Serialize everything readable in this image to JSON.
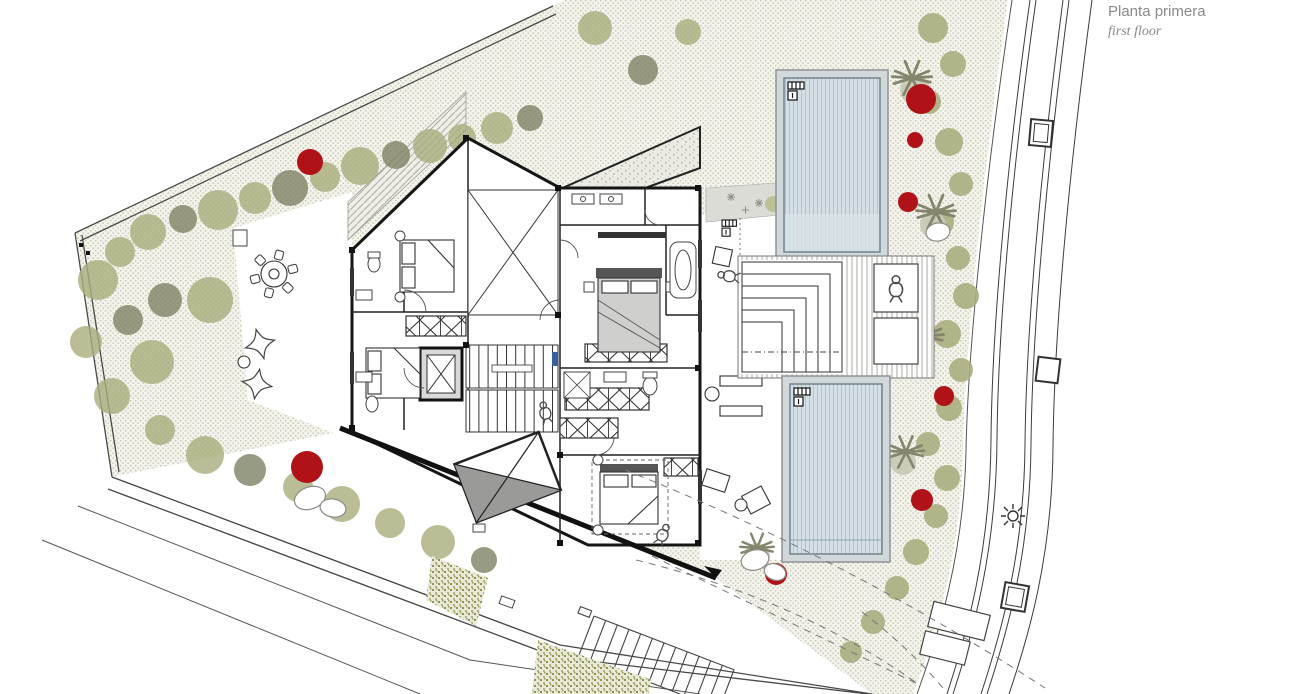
{
  "title": {
    "primary": "Planta primera",
    "secondary": "first floor"
  },
  "palette": {
    "paper": "#ffffff",
    "ink": "#3c3c3c",
    "wall": "#161616",
    "muted_text": "#8a8a88",
    "ground_dot": "#c3c5b0",
    "ground_base": "#f3f3ec",
    "tree_light": "#a9ac7c",
    "tree_dark": "#7e8264",
    "palm_gray": "#83866c",
    "canopy_beige": "#c9c9b7",
    "bush_red": "#b01217",
    "pool_water": "#d4e0e6",
    "pool_stripe": "#aec4cf",
    "pool_rim": "#d2d8da",
    "gravel": "#e6e6df",
    "skylight_gray": "#9a9a98",
    "bed_gray": "#cfcfcd",
    "marker_blue": "#3a5fa0"
  }
}
